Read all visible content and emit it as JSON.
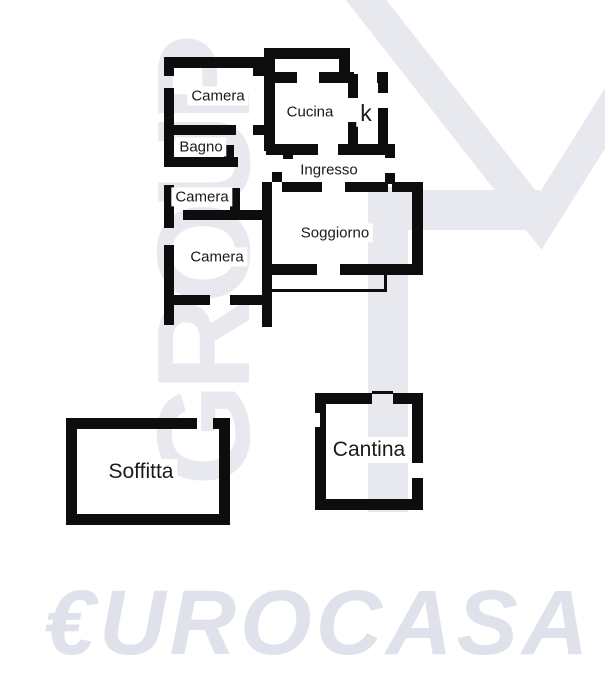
{
  "page": {
    "width": 605,
    "height": 680,
    "background": "#ffffff"
  },
  "colors": {
    "wall": "#0d0d0d",
    "label_text": "#1a1a1a",
    "watermark_gray": "#e7e9ef",
    "eurocasa_gray": "#dfe2ea"
  },
  "watermarks": {
    "group_text": "GROUP",
    "eurocasa_text": "€UROCASA",
    "triangle_points": "341,-32 540,222 648,50",
    "triangle_stroke_width": 32,
    "rects": [
      [
        368,
        187,
        40,
        325
      ],
      [
        400,
        190,
        140,
        40
      ]
    ]
  },
  "floorplan": {
    "rooms": [
      {
        "id": "camera-top",
        "label": "Camera",
        "x": 218,
        "y": 96,
        "size": 15
      },
      {
        "id": "cucina",
        "label": "Cucina",
        "x": 310,
        "y": 112,
        "size": 15
      },
      {
        "id": "kitchenette",
        "label": "k",
        "x": 366,
        "y": 113,
        "size": 23
      },
      {
        "id": "bagno",
        "label": "Bagno",
        "x": 201,
        "y": 147,
        "size": 15
      },
      {
        "id": "ingresso",
        "label": "Ingresso",
        "x": 329,
        "y": 170,
        "size": 15
      },
      {
        "id": "camera-middle",
        "label": "Camera",
        "x": 202,
        "y": 197,
        "size": 15
      },
      {
        "id": "soggiorno",
        "label": "Soggiorno",
        "x": 335,
        "y": 233,
        "size": 15
      },
      {
        "id": "camera-bottom",
        "label": "Camera",
        "x": 217,
        "y": 257,
        "size": 15
      },
      {
        "id": "soffitta",
        "label": "Soffitta",
        "x": 141,
        "y": 472,
        "size": 21
      },
      {
        "id": "cantina",
        "label": "Cantina",
        "x": 369,
        "y": 450,
        "size": 21
      }
    ],
    "walls": [
      [
        164,
        57,
        101,
        11
      ],
      [
        164,
        57,
        10,
        19
      ],
      [
        164,
        88,
        10,
        79
      ],
      [
        164,
        185,
        10,
        43
      ],
      [
        164,
        245,
        10,
        80
      ],
      [
        253,
        64,
        12,
        12
      ],
      [
        164,
        125,
        72,
        10
      ],
      [
        253,
        125,
        11,
        10
      ],
      [
        164,
        157,
        74,
        10
      ],
      [
        224,
        145,
        10,
        22
      ],
      [
        230,
        188,
        10,
        32
      ],
      [
        183,
        210,
        79,
        10
      ],
      [
        170,
        295,
        40,
        10
      ],
      [
        230,
        295,
        34,
        10
      ],
      [
        264,
        48,
        86,
        11
      ],
      [
        264,
        48,
        11,
        26
      ],
      [
        339,
        48,
        11,
        26
      ],
      [
        264,
        72,
        33,
        11
      ],
      [
        319,
        72,
        35,
        11
      ],
      [
        377,
        72,
        11,
        11
      ],
      [
        264,
        72,
        11,
        79
      ],
      [
        348,
        74,
        10,
        24
      ],
      [
        348,
        122,
        10,
        29
      ],
      [
        378,
        72,
        10,
        21
      ],
      [
        378,
        108,
        10,
        47
      ],
      [
        266,
        144,
        52,
        11
      ],
      [
        338,
        144,
        50,
        11
      ],
      [
        283,
        150,
        10,
        9
      ],
      [
        272,
        172,
        10,
        10
      ],
      [
        385,
        144,
        10,
        14
      ],
      [
        385,
        173,
        10,
        11
      ],
      [
        282,
        182,
        40,
        10
      ],
      [
        345,
        182,
        43,
        10
      ],
      [
        392,
        182,
        31,
        10
      ],
      [
        262,
        182,
        10,
        145
      ],
      [
        412,
        182,
        11,
        93
      ],
      [
        262,
        264,
        55,
        11
      ],
      [
        340,
        264,
        83,
        11
      ],
      [
        66,
        418,
        131,
        11
      ],
      [
        213,
        418,
        17,
        11
      ],
      [
        66,
        418,
        11,
        107
      ],
      [
        219,
        418,
        11,
        107
      ],
      [
        66,
        514,
        164,
        11
      ],
      [
        315,
        393,
        57,
        11
      ],
      [
        393,
        393,
        30,
        11
      ],
      [
        315,
        393,
        11,
        117
      ],
      [
        412,
        393,
        11,
        70
      ],
      [
        412,
        478,
        11,
        32
      ],
      [
        315,
        499,
        108,
        11
      ]
    ],
    "thin_lines": [
      [
        270,
        289,
        117,
        3
      ],
      [
        384,
        275,
        3,
        16
      ],
      [
        372,
        391,
        21,
        3
      ]
    ],
    "white_notches": [
      [
        315,
        413,
        5,
        14
      ]
    ]
  }
}
